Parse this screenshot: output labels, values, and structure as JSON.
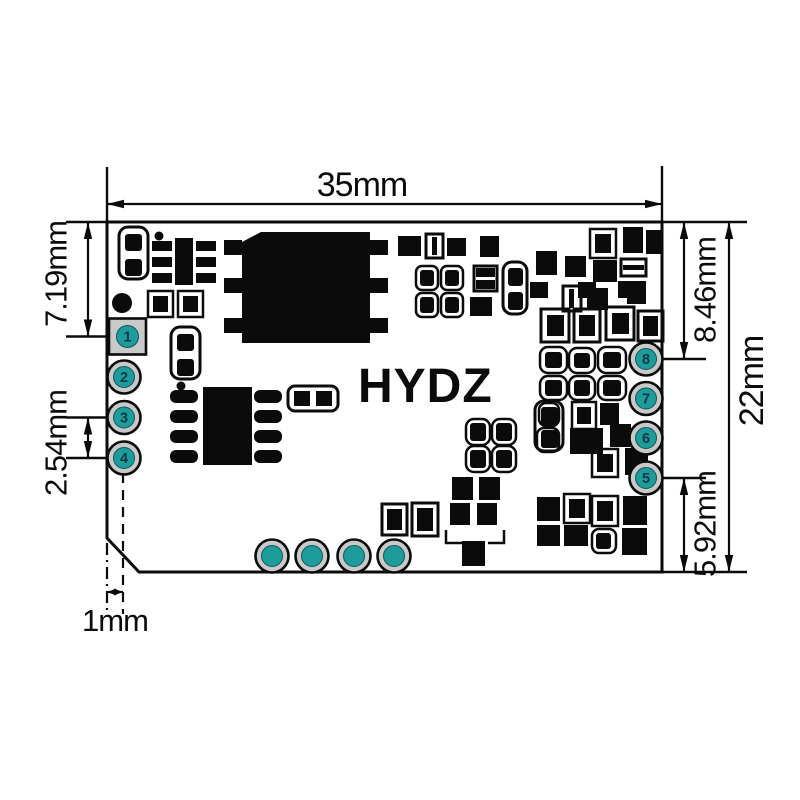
{
  "board": {
    "brand": "HYDZ"
  },
  "dimensions": {
    "width": "35mm",
    "height": "22mm",
    "pin1_from_top": "7.19mm",
    "pin_pitch": "2.54mm",
    "pin8_from_top": "8.46mm",
    "pin5_from_bottom": "5.92mm",
    "pad_edge_offset": "1mm"
  },
  "pads": {
    "left": [
      "1",
      "2",
      "3",
      "4"
    ],
    "right": [
      "8",
      "7",
      "6",
      "5"
    ]
  },
  "colors": {
    "ink": "#0b0b0b",
    "pad_teal": "#1e9b9b",
    "pad_ring_gray": "#c9c9c9",
    "pad_number": "#0e3a46",
    "background": "#ffffff"
  }
}
